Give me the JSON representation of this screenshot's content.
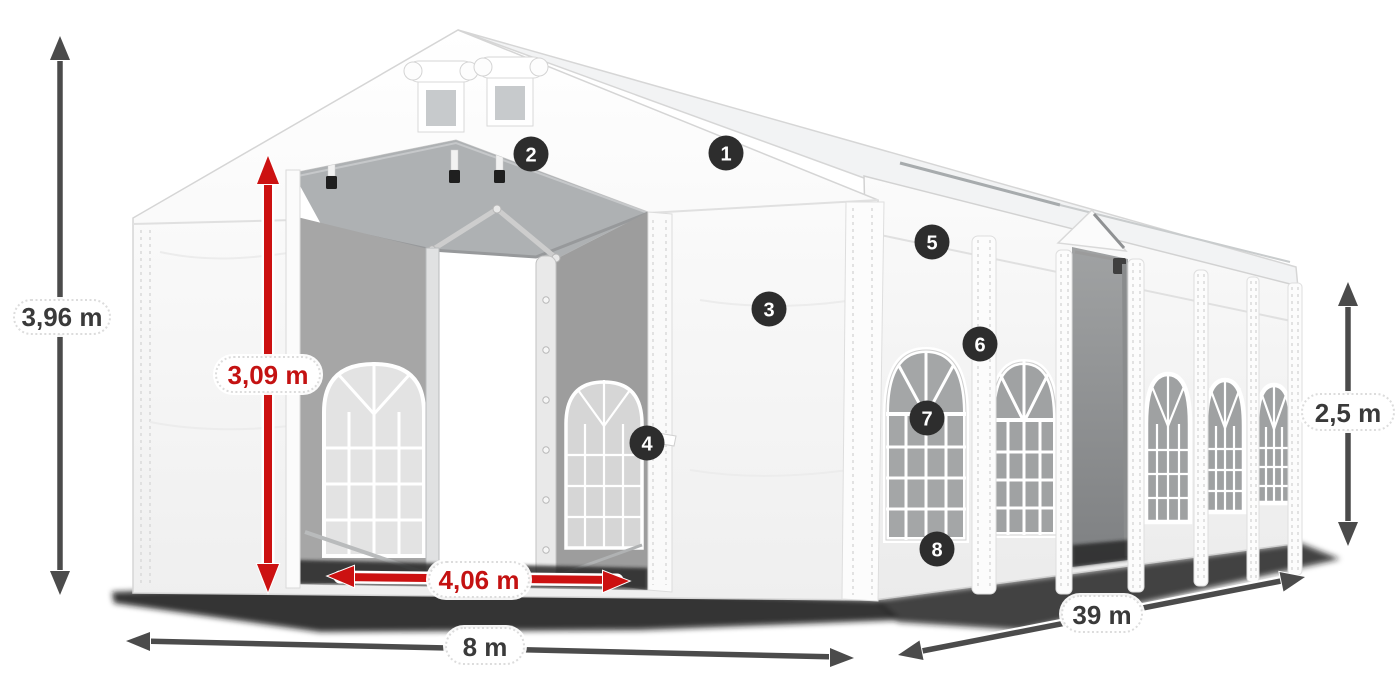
{
  "colors": {
    "background": "#ffffff",
    "accent_red": "#cc1111",
    "arrow_gray": "#4b4b4b",
    "marker_bg": "#2d2d2d",
    "marker_text": "#ffffff",
    "label_text": "#3a3a3a"
  },
  "annotations": {
    "total_height": "3,96 m",
    "door_height": "3,09 m",
    "door_width": "4,06 m",
    "front_width": "8 m",
    "side_length": "39 m",
    "side_height": "2,5 m"
  },
  "markers": [
    {
      "label": "1"
    },
    {
      "label": "2"
    },
    {
      "label": "3"
    },
    {
      "label": "4"
    },
    {
      "label": "5"
    },
    {
      "label": "6"
    },
    {
      "label": "7"
    },
    {
      "label": "8"
    }
  ]
}
